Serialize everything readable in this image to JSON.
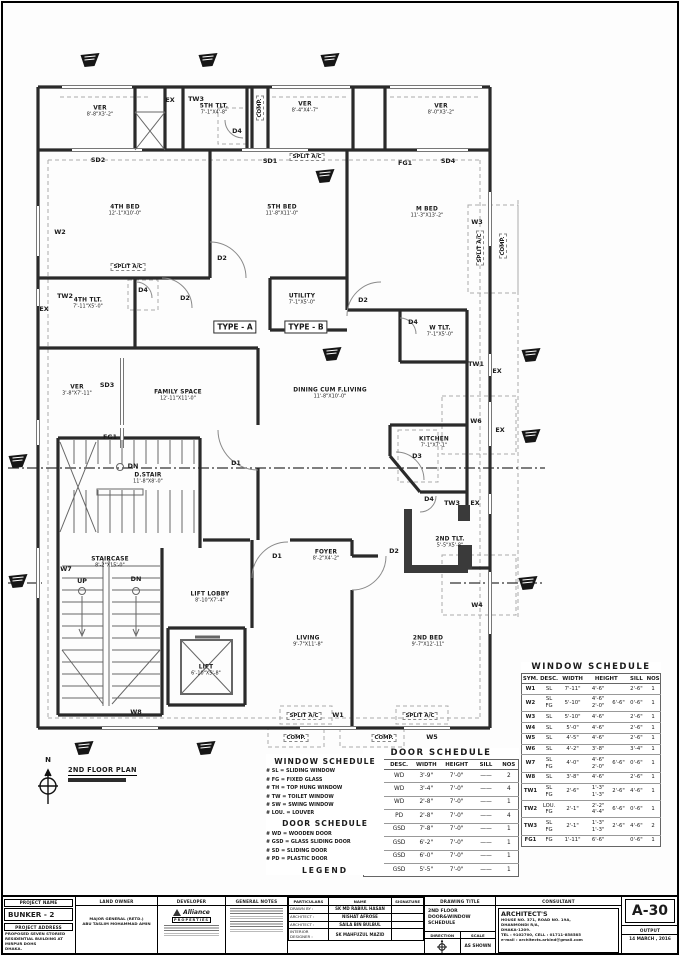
{
  "plan": {
    "north": {
      "letter": "N",
      "title": "2ND FLOOR PLAN",
      "subtitle": "SCALE : AS SHOWN"
    },
    "rooms": [
      {
        "n": "VER",
        "d": "8'-8\"X3'-2\"",
        "x": 100,
        "y": 112
      },
      {
        "n": "5TH TLT.",
        "d": "7'-1\"X4'-8\"",
        "x": 214,
        "y": 110
      },
      {
        "n": "VER",
        "d": "8'-4\"X4'-7\"",
        "x": 305,
        "y": 108
      },
      {
        "n": "VER",
        "d": "8'-0\"X3'-2\"",
        "x": 441,
        "y": 110
      },
      {
        "n": "4TH BED",
        "d": "12'-1\"X10'-0\"",
        "x": 125,
        "y": 211
      },
      {
        "n": "5TH BED",
        "d": "11'-8\"X11'-0\"",
        "x": 282,
        "y": 211
      },
      {
        "n": "M BED",
        "d": "11'-3\"X13'-2\"",
        "x": 427,
        "y": 213
      },
      {
        "n": "4TH TLT.",
        "d": "7'-11\"X5'-0\"",
        "x": 88,
        "y": 304
      },
      {
        "n": "UTILITY",
        "d": "7'-1\"X5'-0\"",
        "x": 302,
        "y": 300
      },
      {
        "n": "W TLT.",
        "d": "7'-1\"X5'-0\"",
        "x": 440,
        "y": 332
      },
      {
        "n": "VER",
        "d": "3'-8\"X7'-11\"",
        "x": 77,
        "y": 391
      },
      {
        "n": "FAMILY SPACE",
        "d": "12'-11\"X11'-0\"",
        "x": 178,
        "y": 396
      },
      {
        "n": "DINING CUM F.LIVING",
        "d": "11'-8\"X10'-0\"",
        "x": 330,
        "y": 394
      },
      {
        "n": "KITCHEN",
        "d": "7'-1\"X7'-1\"",
        "x": 434,
        "y": 443
      },
      {
        "n": "D.STAIR",
        "d": "11'-8\"X8'-0\"",
        "x": 148,
        "y": 479
      },
      {
        "n": "2ND TLT.",
        "d": "5'-5\"X5'-8\"",
        "x": 450,
        "y": 543
      },
      {
        "n": "FOYER",
        "d": "8'-2\"X4'-2\"",
        "x": 326,
        "y": 556
      },
      {
        "n": "STAIRCASE",
        "d": "8'-2\"X15'-0\"",
        "x": 110,
        "y": 563
      },
      {
        "n": "LIFT LOBBY",
        "d": "8'-10\"X7'-4\"",
        "x": 210,
        "y": 598
      },
      {
        "n": "LIVING",
        "d": "9'-7\"X11'-8\"",
        "x": 308,
        "y": 642
      },
      {
        "n": "2ND BED",
        "d": "9'-7\"X12'-11\"",
        "x": 428,
        "y": 642
      },
      {
        "n": "LIFT",
        "d": "6'-10\"X5'-8\"",
        "x": 206,
        "y": 671
      }
    ],
    "tags": [
      {
        "t": "EX",
        "x": 170,
        "y": 100
      },
      {
        "t": "TW3",
        "x": 196,
        "y": 99
      },
      {
        "t": "D4",
        "x": 237,
        "y": 131
      },
      {
        "t": "COMP.",
        "x": 260,
        "y": 108,
        "v": true,
        "s": "dash"
      },
      {
        "t": "SD2",
        "x": 98,
        "y": 160
      },
      {
        "t": "SD1",
        "x": 270,
        "y": 161
      },
      {
        "t": "SPLIT A/C",
        "x": 307,
        "y": 157,
        "s": "dash"
      },
      {
        "t": "FG1",
        "x": 405,
        "y": 163
      },
      {
        "t": "SD4",
        "x": 448,
        "y": 161
      },
      {
        "t": "W2",
        "x": 60,
        "y": 232
      },
      {
        "t": "W3",
        "x": 477,
        "y": 222
      },
      {
        "t": "SPLIT A/C",
        "x": 480,
        "y": 248,
        "v": true,
        "s": "dash"
      },
      {
        "t": "COMP.",
        "x": 503,
        "y": 246,
        "v": true,
        "s": "dash"
      },
      {
        "t": "SPLIT A/C",
        "x": 128,
        "y": 267,
        "s": "dash"
      },
      {
        "t": "D2",
        "x": 222,
        "y": 258
      },
      {
        "t": "TW2",
        "x": 65,
        "y": 296
      },
      {
        "t": "EX",
        "x": 44,
        "y": 309
      },
      {
        "t": "D4",
        "x": 143,
        "y": 290
      },
      {
        "t": "D2",
        "x": 185,
        "y": 298
      },
      {
        "t": "D2",
        "x": 363,
        "y": 300
      },
      {
        "t": "D4",
        "x": 413,
        "y": 322
      },
      {
        "t": "TYPE - A",
        "x": 235,
        "y": 327,
        "s": "box"
      },
      {
        "t": "TYPE - B",
        "x": 306,
        "y": 327,
        "s": "box"
      },
      {
        "t": "SD3",
        "x": 107,
        "y": 385
      },
      {
        "t": "FG1",
        "x": 110,
        "y": 437
      },
      {
        "t": "TW1",
        "x": 476,
        "y": 364
      },
      {
        "t": "EX",
        "x": 497,
        "y": 371
      },
      {
        "t": "W6",
        "x": 476,
        "y": 421
      },
      {
        "t": "EX",
        "x": 500,
        "y": 430
      },
      {
        "t": "D3",
        "x": 417,
        "y": 456
      },
      {
        "t": "D1",
        "x": 236,
        "y": 463
      },
      {
        "t": "DN",
        "x": 133,
        "y": 466
      },
      {
        "t": "TW3",
        "x": 452,
        "y": 503
      },
      {
        "t": "EX",
        "x": 475,
        "y": 503
      },
      {
        "t": "D4",
        "x": 429,
        "y": 499
      },
      {
        "t": "D2",
        "x": 394,
        "y": 551
      },
      {
        "t": "D1",
        "x": 277,
        "y": 556
      },
      {
        "t": "W4",
        "x": 477,
        "y": 605
      },
      {
        "t": "W7",
        "x": 66,
        "y": 569
      },
      {
        "t": "UP",
        "x": 82,
        "y": 581
      },
      {
        "t": "DN",
        "x": 136,
        "y": 579
      },
      {
        "t": "W8",
        "x": 136,
        "y": 712
      },
      {
        "t": "SPLIT A/C",
        "x": 304,
        "y": 716,
        "s": "dash"
      },
      {
        "t": "W1",
        "x": 338,
        "y": 715
      },
      {
        "t": "COMP.",
        "x": 296,
        "y": 738,
        "s": "dash"
      },
      {
        "t": "SPLIT A/C",
        "x": 420,
        "y": 716,
        "s": "dash"
      },
      {
        "t": "COMP.",
        "x": 384,
        "y": 738,
        "s": "dash"
      },
      {
        "t": "W5",
        "x": 432,
        "y": 737
      }
    ],
    "markers": [
      {
        "x": 90,
        "y": 62
      },
      {
        "x": 208,
        "y": 62
      },
      {
        "x": 330,
        "y": 62
      },
      {
        "x": 325,
        "y": 178
      },
      {
        "x": 332,
        "y": 356
      },
      {
        "x": 18,
        "y": 463
      },
      {
        "x": 18,
        "y": 583
      },
      {
        "x": 531,
        "y": 357
      },
      {
        "x": 531,
        "y": 438
      },
      {
        "x": 528,
        "y": 585
      },
      {
        "x": 84,
        "y": 750
      },
      {
        "x": 206,
        "y": 750
      }
    ]
  },
  "window_schedule": {
    "title": "WINDOW SCHEDULE",
    "headers": [
      "SYM.",
      "DESC.",
      "WIDTH",
      "HEIGHT",
      "SILL",
      "NOS"
    ],
    "rows": [
      [
        "W1",
        "SL",
        "7'-11\"",
        "4'-6\"",
        "",
        "2'-6\"",
        "1"
      ],
      [
        "W2",
        "SL\nFG",
        "5'-10\"",
        "4'-6\"\n2'-0\"",
        "6'-6\"",
        "0'-6\"",
        "1"
      ],
      [
        "W3",
        "SL",
        "5'-10\"",
        "4'-6\"",
        "",
        "2'-6\"",
        "1"
      ],
      [
        "W4",
        "SL",
        "5'-0\"",
        "4'-6\"",
        "",
        "2'-6\"",
        "1"
      ],
      [
        "W5",
        "SL",
        "4'-5\"",
        "4'-6\"",
        "",
        "2'-6\"",
        "1"
      ],
      [
        "W6",
        "SL",
        "4'-2\"",
        "3'-8\"",
        "",
        "3'-4\"",
        "1"
      ],
      [
        "W7",
        "SL\nFG",
        "4'-0\"",
        "4'-6\"\n2'-0\"",
        "6'-6\"",
        "0'-6\"",
        "1"
      ],
      [
        "W8",
        "SL",
        "3'-8\"",
        "4'-6\"",
        "",
        "2'-6\"",
        "1"
      ],
      [
        "TW1",
        "SL\nFG",
        "2'-6\"",
        "1'-3\"\n1'-3\"",
        "2'-6\"",
        "4'-6\"",
        "1"
      ],
      [
        "TW2",
        "LOU.\nFG",
        "2'-1\"",
        "2'-2\"\n4'-4\"",
        "6'-6\"",
        "0'-6\"",
        "1"
      ],
      [
        "TW3",
        "SL\nFG",
        "2'-1\"",
        "1'-3\"\n1'-3\"",
        "2'-6\"",
        "4'-6\"",
        "2"
      ],
      [
        "FG1",
        "FG",
        "1'-11\"",
        "6'-6\"",
        "",
        "0'-6\"",
        "1"
      ]
    ]
  },
  "door_schedule": {
    "title": "DOOR SCHEDULE",
    "headers": [
      "SYM.",
      "DESC.",
      "WIDTH",
      "HEIGHT",
      "SILL",
      "NOS"
    ],
    "rows": [
      [
        "D1",
        "WD",
        "3'-9\"",
        "7'-0\"",
        "——",
        "2"
      ],
      [
        "D2",
        "WD",
        "3'-4\"",
        "7'-0\"",
        "——",
        "4"
      ],
      [
        "D3",
        "WD",
        "2'-8\"",
        "7'-0\"",
        "——",
        "1"
      ],
      [
        "D4",
        "PD",
        "2'-8\"",
        "7'-0\"",
        "——",
        "4"
      ],
      [
        "SD1",
        "GSD",
        "7'-8\"",
        "7'-0\"",
        "——",
        "1"
      ],
      [
        "SD2",
        "GSD",
        "6'-2\"",
        "7'-0\"",
        "——",
        "1"
      ],
      [
        "SD3",
        "GSD",
        "6'-0\"",
        "7'-0\"",
        "——",
        "1"
      ],
      [
        "SD4",
        "GSD",
        "5'-5\"",
        "7'-0\"",
        "——",
        "1"
      ]
    ]
  },
  "legend": {
    "window_title": "WINDOW SCHEDULE",
    "window_items": [
      "# SL  = SLIDING WINDOW",
      "# FG  = FIXED GLASS",
      "# TH  = TOP HUNG WINDOW",
      "# TW  = TOILET WINDOW",
      "# SW  = SWING WINDOW",
      "# LOU. = LOUVER"
    ],
    "door_title": "DOOR SCHEDULE",
    "door_items": [
      "# WD  = WOODEN DOOR",
      "# GSD = GLASS SLIDING DOOR",
      "# SD  = SLIDING DOOR",
      "# PD  = PLASTIC DOOR"
    ],
    "footer": "LEGEND"
  },
  "title_block": {
    "project_label": "PROJECT NAME",
    "project_name": "BUNKER - 2",
    "address_label": "PROJECT ADDRESS",
    "address_lines": [
      "PROPOSED SEVEN STORIED",
      "RESIDENTIAL BUILDING AT",
      "MIRPUR DOHS",
      "DHAKA."
    ],
    "owner_label": "LAND OWNER",
    "owner_lines": [
      "MAJOR GENERAL (RETD.)",
      "ABU TASLIM MOHAMMAD AMIN"
    ],
    "developer_label": "DEVELOPER",
    "developer_name": "Alliance",
    "developer_sub": "PROPERTIES",
    "notes_label": "GENERAL NOTES",
    "particulars_headers": [
      "PARTICULARS",
      "NAME",
      "SIGNATURE"
    ],
    "particulars_rows": [
      [
        "DRAWN BY :",
        "SK MD RABIUL HASAN",
        ""
      ],
      [
        "ARCHITECT :",
        "NISHAT AFROSE",
        ""
      ],
      [
        "ARCHITECT :",
        "SAILA BIN BULBUL",
        ""
      ],
      [
        "INTERIOR DESIGNER :",
        "SK MAHFUZUL MAZID",
        ""
      ]
    ],
    "title_label": "DRAWING TITLE",
    "title_lines": [
      "2ND FLOOR",
      "DOOR&WINDOW SCHEDULE"
    ],
    "direction_label": "DIRECTION",
    "scale_label": "SCALE",
    "scale_value": "AS SHOWN",
    "consultant_label": "CONSULTANT",
    "consultant_name": "ARCHITECT'S",
    "consultant_lines": [
      "HOUSE NO. 371, ROAD NO. 19A,",
      "DHANMONDI R/A,",
      "DHAKA-1209.",
      "TEL : 9102700, CELL : 01711-858585",
      "e-mail : architects.arkind@gmail.com"
    ],
    "sheet_no": "A-30",
    "output_label": "OUTPUT",
    "output_date": "14 MARCH , 2016"
  }
}
